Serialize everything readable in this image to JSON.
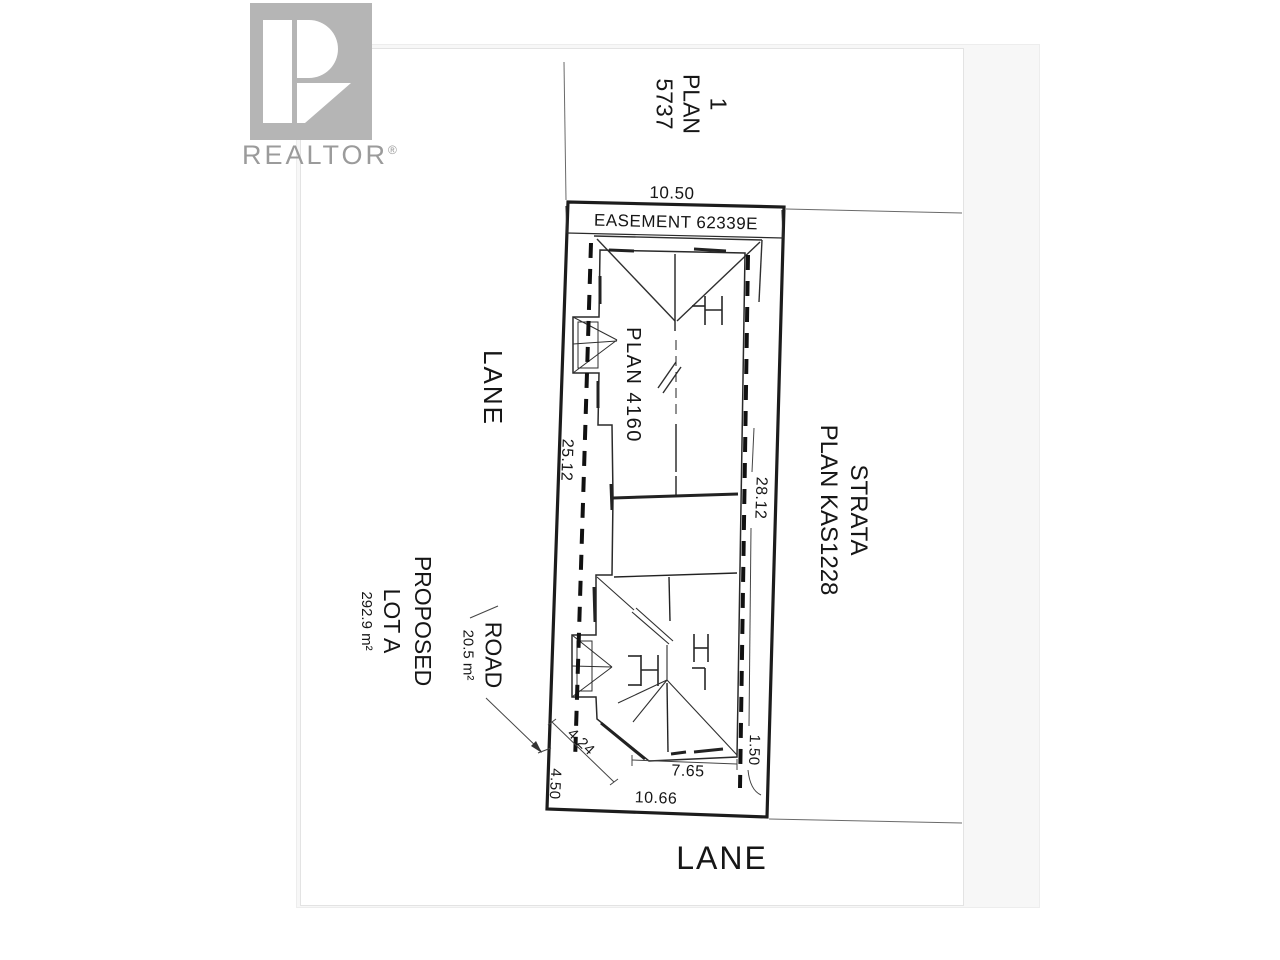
{
  "branding": {
    "logo_text": "REALTOR",
    "registered": "®"
  },
  "labels": {
    "neighbor_top": [
      "1",
      "PLAN",
      "5737"
    ],
    "strata": [
      "STRATA",
      "PLAN KAS1228"
    ],
    "lane_left": "LANE",
    "lane_bottom": "LANE",
    "easement": "EASEMENT 62339E",
    "building_plan": "PLAN 4160",
    "proposed_title": "PROPOSED",
    "proposed_lot": "LOT A",
    "proposed_area": "292.9 m²",
    "road_label": "ROAD",
    "road_area": "20.5 m²"
  },
  "dimensions": {
    "top": "10.50",
    "west": "25.12",
    "east": "28.12",
    "diagonal": "4.24",
    "west_lower": "4.50",
    "building_bottom": "7.65",
    "east_lower": "1.50",
    "south": "10.66"
  },
  "colors": {
    "line": "#1c1c1c",
    "logo_gray": "#b5b5b5",
    "text_gray": "#9b9b9b"
  }
}
